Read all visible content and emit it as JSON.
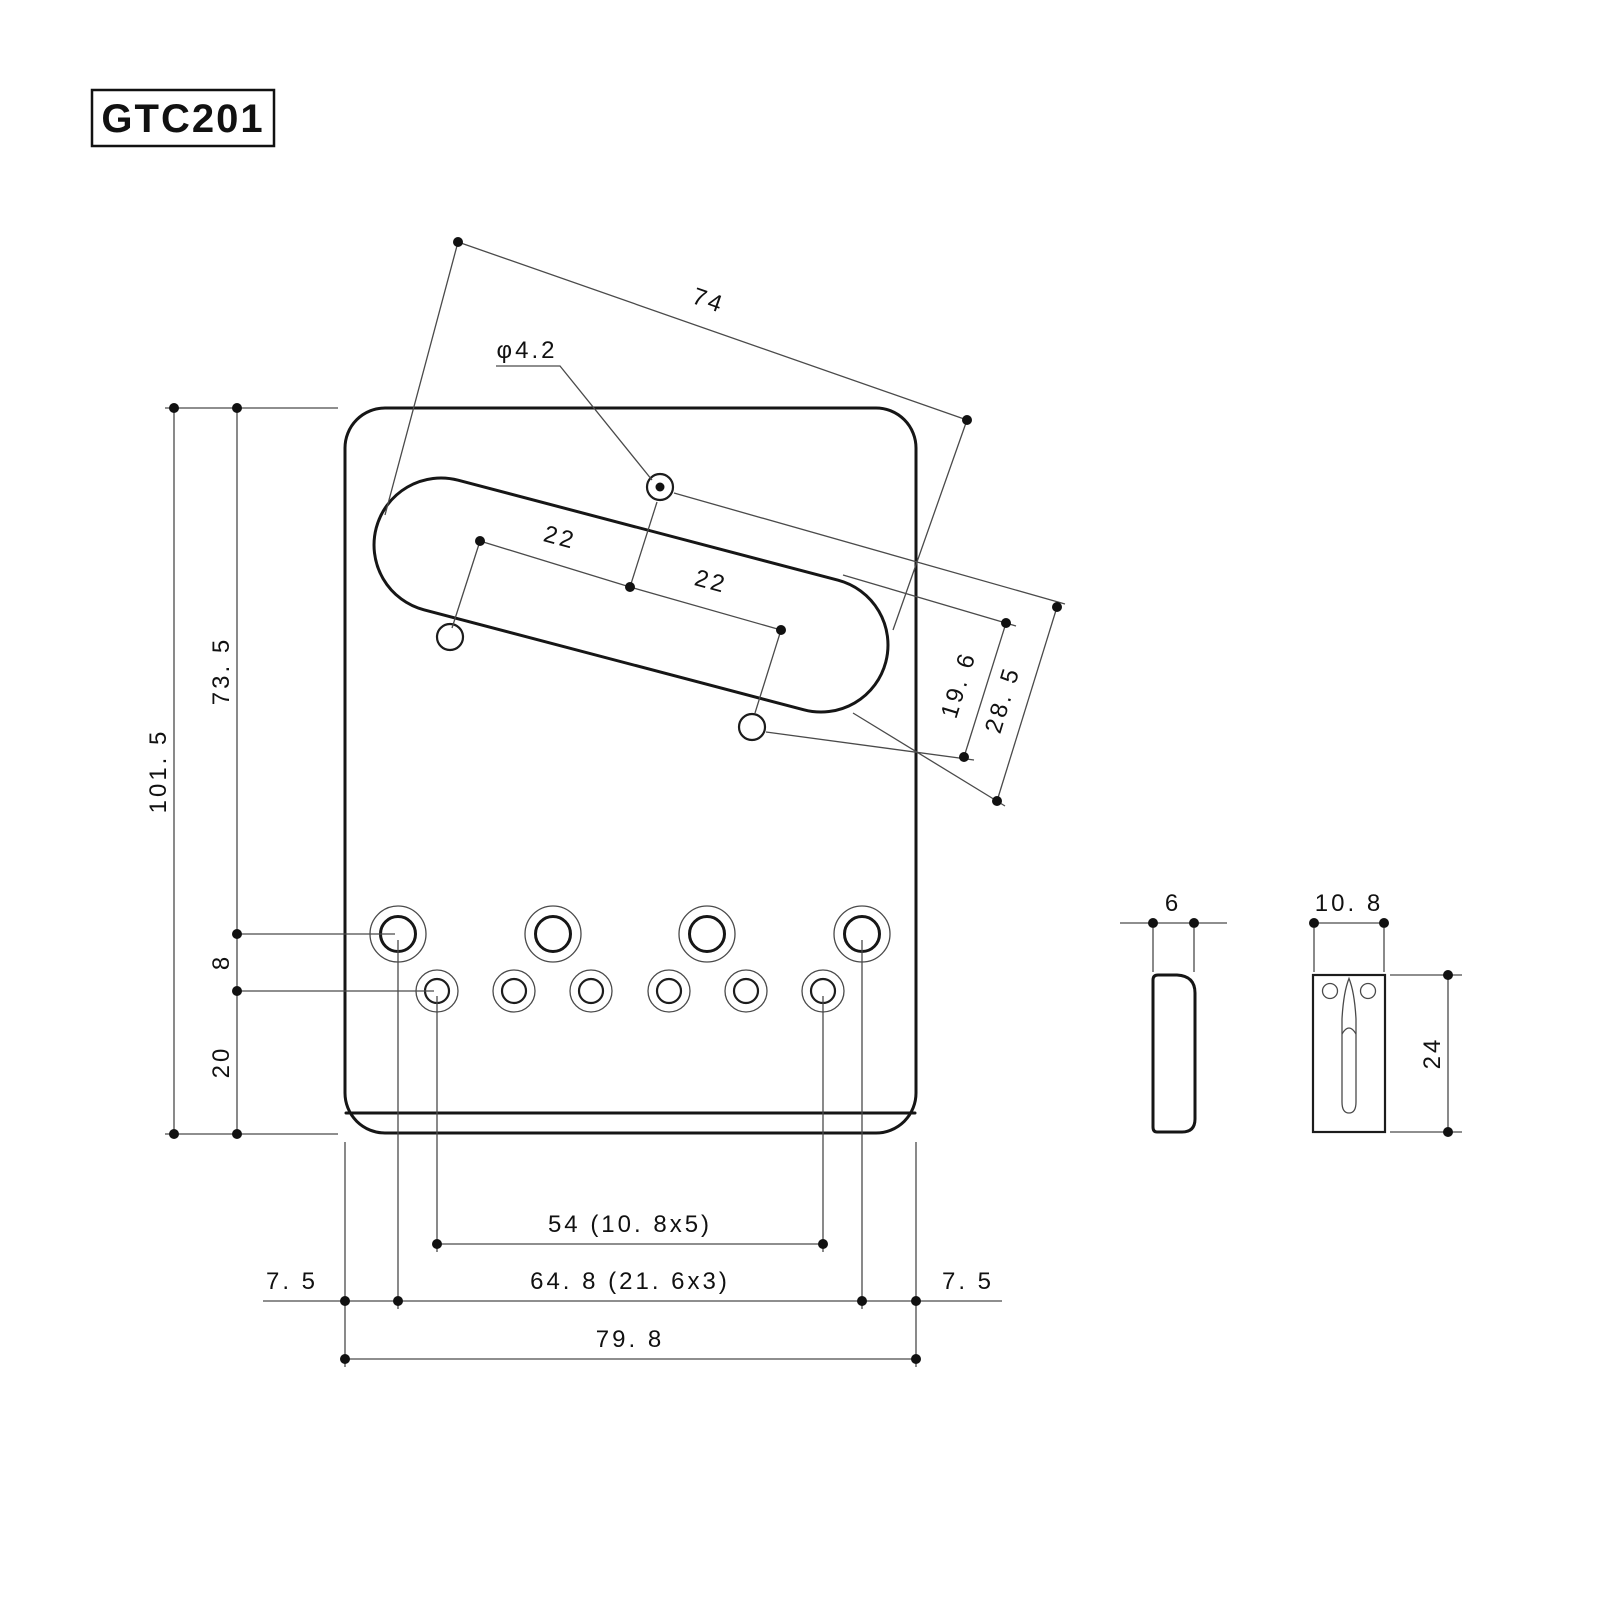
{
  "part": {
    "code": "GTC201"
  },
  "dims": {
    "cutout_length": "74",
    "hole_dia": "φ4.2",
    "pitch_a": "22",
    "pitch_b": "22",
    "offset_a": "19. 6",
    "offset_b": "28. 5",
    "height_total": "101. 5",
    "height_upper": "73. 5",
    "row_gap": "8",
    "bottom_gap": "20",
    "small_hole_span": "54 (10. 8x5)",
    "big_hole_span": "64. 8 (21. 6x3)",
    "edge_margin_left": "7. 5",
    "edge_margin_right": "7. 5",
    "overall_width": "79. 8",
    "saddle_thickness": "6",
    "saddle_width": "10. 8",
    "saddle_height": "24"
  }
}
